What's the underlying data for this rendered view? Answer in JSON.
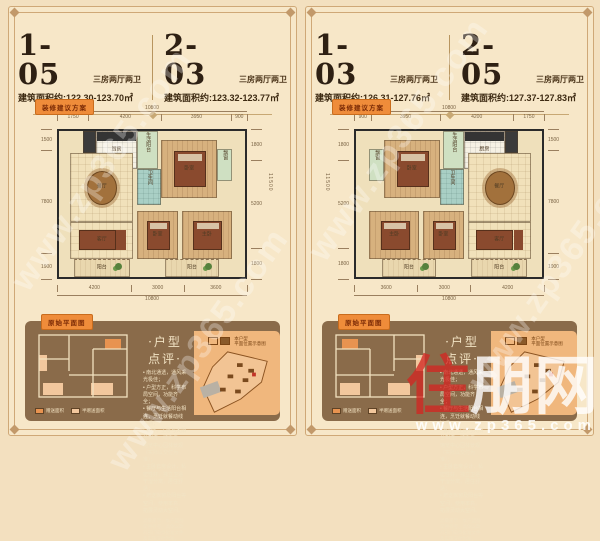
{
  "page": {
    "bg": "#f3e0bf",
    "frame_color": "#cfa877",
    "watermark_diagonal": "www.zp365.com",
    "logo": {
      "red_char": "住",
      "white_chars": "朋网",
      "url": "www.zp365.com"
    }
  },
  "floorplan": {
    "rooms": [
      {
        "label": "",
        "x": 13,
        "y": 0,
        "w": 7,
        "h": 15,
        "floor": "dark",
        "furn": ""
      },
      {
        "label": "厨房",
        "x": 20,
        "y": 0,
        "w": 22,
        "h": 26,
        "floor": "white",
        "furn": "counter"
      },
      {
        "label": "生活阳台",
        "x": 42,
        "y": 0,
        "w": 11,
        "h": 26,
        "floor": "green",
        "furn": ""
      },
      {
        "label": "卧室",
        "x": 55,
        "y": 6,
        "w": 30,
        "h": 40,
        "floor": "wood",
        "furn": "bed"
      },
      {
        "label": "飘窗",
        "x": 85,
        "y": 12,
        "w": 8,
        "h": 22,
        "floor": "green",
        "furn": ""
      },
      {
        "label": "餐厅",
        "x": 6,
        "y": 15,
        "w": 34,
        "h": 47,
        "floor": "tile",
        "furn": "table"
      },
      {
        "label": "卫生间",
        "x": 42,
        "y": 26,
        "w": 13,
        "h": 25,
        "floor": "teal",
        "furn": ""
      },
      {
        "label": "客厅",
        "x": 6,
        "y": 62,
        "w": 34,
        "h": 26,
        "floor": "tile",
        "furn": "sofa"
      },
      {
        "label": "卧室",
        "x": 42,
        "y": 55,
        "w": 22,
        "h": 33,
        "floor": "wood",
        "furn": "bed"
      },
      {
        "label": "主卧",
        "x": 66,
        "y": 55,
        "w": 27,
        "h": 33,
        "floor": "wood",
        "furn": "bed"
      },
      {
        "label": "阳台",
        "x": 8,
        "y": 88,
        "w": 30,
        "h": 12,
        "floor": "balc",
        "furn": "plant"
      },
      {
        "label": "阳台",
        "x": 57,
        "y": 88,
        "w": 29,
        "h": 12,
        "floor": "balc",
        "furn": "plant"
      }
    ]
  },
  "panels": [
    {
      "units": [
        {
          "number": "1-05",
          "type": "三房两厅两卫",
          "area": "建筑面积约:122.30-123.70㎡"
        },
        {
          "number": "2-03",
          "type": "三房两厅两卫",
          "area": "建筑面积约:123.32-123.77㎡"
        }
      ],
      "plan_tag": "装修建议方案",
      "original_tag": "原始平面图",
      "review_title": "·户型点评·",
      "review_bullets": [
        "南北通透，通风采光极佳；",
        "户型方正，科学布局空间，功能齐全；",
        "餐厅与生活阳台相连，烹饪就餐动线流畅；",
        "客厅、主卧与大阳台相连一线采光，饱览中心园林景观（实际以交付为准）；",
        "主卧套房设计，私密性好，独立卫浴干湿分离，居住舒适；",
        "赠送飘窗及阳台等空间，使用率高，拓展灵动大空间。"
      ],
      "disclaimer": "温馨提示：本户型图仅供参考，具体以政府部门最终批准文件及实际交付为准。",
      "legend": [
        {
          "color": "#e89350",
          "label": "赠送面积"
        },
        {
          "color": "#f2c79d",
          "label": "半赠送面积"
        }
      ],
      "site_legend_line1": "本户型",
      "site_legend_line2": "平面位置示意图",
      "mirror": false,
      "dims": {
        "top_total": "10800",
        "top_segs": [
          "1750",
          "4200",
          "3950",
          "900"
        ],
        "bottom_segs": [
          "4200",
          "3000",
          "3600"
        ],
        "bottom_total": "10800",
        "left_segs": [
          "1500",
          "7800",
          "1900"
        ],
        "right_segs": [
          "1800",
          "5200",
          "1800"
        ],
        "right_total": "11500"
      }
    },
    {
      "units": [
        {
          "number": "1-03",
          "type": "三房两厅两卫",
          "area": "建筑面积约:126.31-127.76㎡"
        },
        {
          "number": "2-05",
          "type": "三房两厅两卫",
          "area": "建筑面积约:127.37-127.83㎡"
        }
      ],
      "plan_tag": "装修建议方案",
      "original_tag": "原始平面图",
      "review_title": "·户型点评·",
      "review_bullets": [
        "南北通透，通风采光极佳；",
        "户型方正，科学布局空间，功能齐全；",
        "餐厅与生活阳台相连，烹饪就餐动线流畅；",
        "客厅、主卧与大阳台相连一线采光，饱览中心园林景观（实际以交付为准）；",
        "主卧套房设计，私密性好，独立卫浴干湿分离，居住舒适；",
        "赠送飘窗及阳台等空间，使用率高，拓展灵动大空间。"
      ],
      "disclaimer": "温馨提示：本户型图仅供参考，具体以政府部门最终批准文件及实际交付为准。",
      "legend": [
        {
          "color": "#e89350",
          "label": "赠送面积"
        },
        {
          "color": "#f2c79d",
          "label": "半赠送面积"
        }
      ],
      "site_legend_line1": "本户型",
      "site_legend_line2": "平面位置示意图",
      "mirror": true,
      "dims": {
        "top_total": "10800",
        "top_segs": [
          "900",
          "3950",
          "4200",
          "1750"
        ],
        "bottom_segs": [
          "3600",
          "3000",
          "4200"
        ],
        "bottom_total": "10800",
        "left_segs": [
          "1800",
          "5200",
          "1800"
        ],
        "left_total": "11500",
        "right_segs": [
          "1500",
          "7800",
          "1900"
        ]
      }
    }
  ]
}
